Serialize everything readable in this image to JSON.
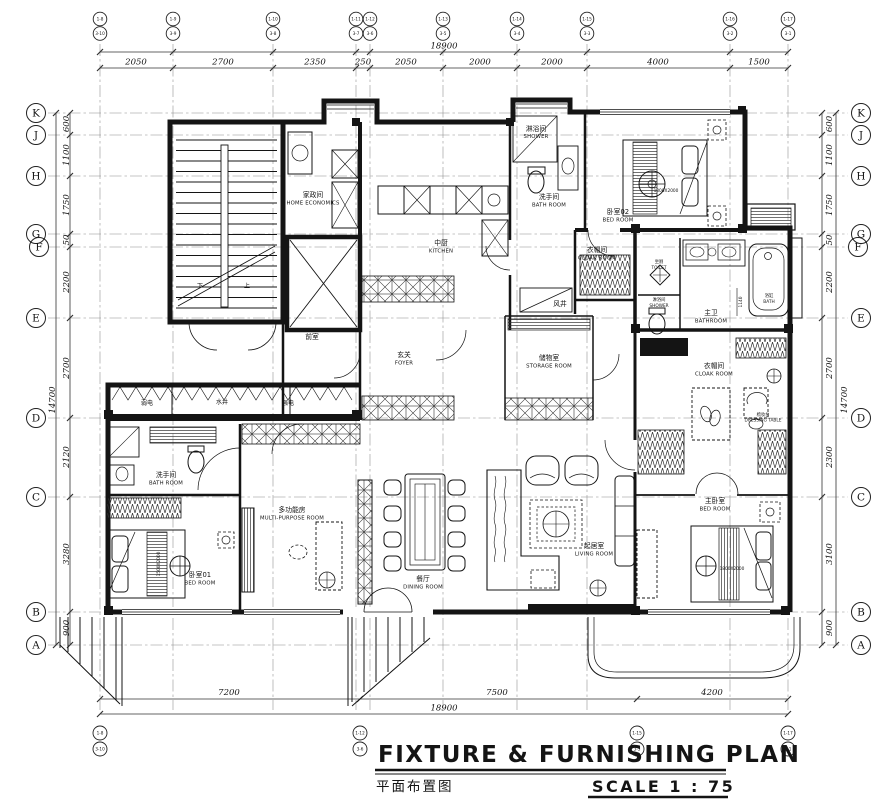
{
  "title": {
    "en": "FIXTURE & FURNISHING PLAN",
    "zh": "平面布置图",
    "scale": "SCALE  1 : 75"
  },
  "grid": {
    "row_labels": [
      "K",
      "J",
      "H",
      "G",
      "F",
      "E",
      "D",
      "C",
      "B",
      "A"
    ],
    "top_bubbles": [
      {
        "a": "1-8",
        "b": "3-10"
      },
      {
        "a": "1-9",
        "b": "3-9"
      },
      {
        "a": "1-10",
        "b": "3-8"
      },
      {
        "a": "1-11",
        "b": "3-7"
      },
      {
        "a": "1-12",
        "b": "3-6"
      },
      {
        "a": "1-13",
        "b": "3-5"
      },
      {
        "a": "1-14",
        "b": "3-4"
      },
      {
        "a": "1-15",
        "b": "3-3"
      },
      {
        "a": "1-16",
        "b": "3-2"
      },
      {
        "a": "1-17",
        "b": "3-1"
      }
    ],
    "bottom_bubbles": [
      {
        "a": "1-8",
        "b": "3-10"
      },
      {
        "a": "1-12",
        "b": "3-6"
      },
      {
        "a": "1-15",
        "b": "3-3"
      },
      {
        "a": "1-17",
        "b": "3-1"
      }
    ]
  },
  "dims": {
    "top": [
      "2050",
      "2700",
      "2350",
      "250",
      "2050",
      "2000",
      "2000",
      "4000",
      "1500"
    ],
    "top_total": "18900",
    "bottom": [
      "7200",
      "7500",
      "4200"
    ],
    "bottom_total": "18900",
    "left": [
      "600",
      "1100",
      "1750",
      "50",
      "2200",
      "2700",
      "2120",
      "3280",
      "900"
    ],
    "left_total": "14700",
    "right": [
      "600",
      "1100",
      "1750",
      "50",
      "2200",
      "2700",
      "2300",
      "3100",
      "900"
    ],
    "right_total": "14700"
  },
  "rooms": [
    {
      "zh": "家政间",
      "en": "HOME ECONOMICS"
    },
    {
      "zh": "中厨",
      "en": "KITCHEN"
    },
    {
      "zh": "淋浴间",
      "en": "SHOWER"
    },
    {
      "zh": "洗手间",
      "en": "BATH ROOM"
    },
    {
      "zh": "卧室02",
      "en": "BED ROOM"
    },
    {
      "zh": "衣帽间",
      "en": "CLOAK ROOM"
    },
    {
      "zh": "风井",
      "en": ""
    },
    {
      "zh": "玄关",
      "en": "FOYER"
    },
    {
      "zh": "前室",
      "en": ""
    },
    {
      "zh": "储物室",
      "en": "STORAGE ROOM"
    },
    {
      "zh": "弱电",
      "en": ""
    },
    {
      "zh": "水井",
      "en": ""
    },
    {
      "zh": "强电",
      "en": ""
    },
    {
      "zh": "洗手间",
      "en": "BATH ROOM"
    },
    {
      "zh": "多功能房",
      "en": "MULTI-PURPOSE ROOM"
    },
    {
      "zh": "卧室01",
      "en": "BED ROOM"
    },
    {
      "zh": "餐厅",
      "en": "DINING ROOM"
    },
    {
      "zh": "起居室",
      "en": "LIVING ROOM"
    },
    {
      "zh": "坐厕",
      "en": "TOILET"
    },
    {
      "zh": "淋浴间",
      "en": "SHOWER"
    },
    {
      "zh": "主卫",
      "en": "BATHROOM"
    },
    {
      "zh": "浴缸",
      "en": "BATH"
    },
    {
      "zh": "衣帽间",
      "en": "CLOAK ROOM"
    },
    {
      "zh": "梳妆台",
      "en": "DRESSING TABLE"
    },
    {
      "zh": "主卧室",
      "en": "BED ROOM"
    }
  ],
  "annotations": {
    "stair_down": "下",
    "stair_up": "上",
    "bath_dim": "1140",
    "bed01_size": "1500X2000",
    "bed02_size": "1800X2000",
    "master_bed_size": "1800X2000"
  },
  "colors": {
    "line": "#141414",
    "background": "#ffffff"
  }
}
